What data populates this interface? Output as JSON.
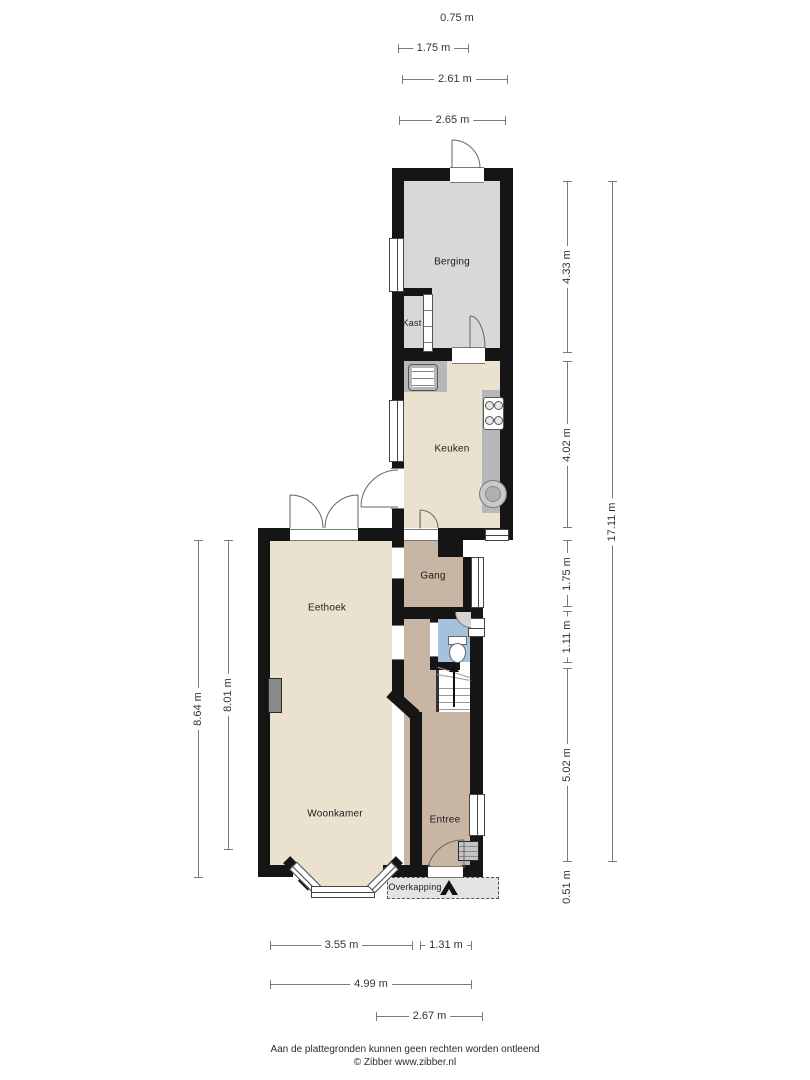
{
  "rooms": {
    "berging": "Berging",
    "kast": "Kast",
    "keuken": "Keuken",
    "gang": "Gang",
    "eethoek": "Eethoek",
    "woonkamer": "Woonkamer",
    "entree": "Entree",
    "overkapping": "Overkapping"
  },
  "dimensions": {
    "top": [
      "0.75 m",
      "1.75 m",
      "2.61 m",
      "2.65 m"
    ],
    "right_inner": [
      "4.33 m",
      "4.02 m",
      "1.75 m",
      "1.11 m",
      "5.02 m",
      "0.51 m"
    ],
    "right_outer": "17.11 m",
    "left": [
      "8.64 m",
      "8.01 m"
    ],
    "bottom": [
      "3.55 m",
      "1.31 m",
      "4.99 m",
      "2.67 m"
    ]
  },
  "footer": {
    "line1": "Aan de plattegronden kunnen geen rechten worden ontleend",
    "line2": "© Zibber www.zibber.nl"
  },
  "colors": {
    "wall": "#151515",
    "floor_storage": "#d8d8d8",
    "floor_living": "#eae2cf",
    "floor_hall": "#c8b5a3",
    "floor_toilet": "#a5c1dc",
    "counter": "#b5b7b9",
    "overkapping": "#e3e3e3",
    "dimension_line": "#7a7a7a"
  }
}
